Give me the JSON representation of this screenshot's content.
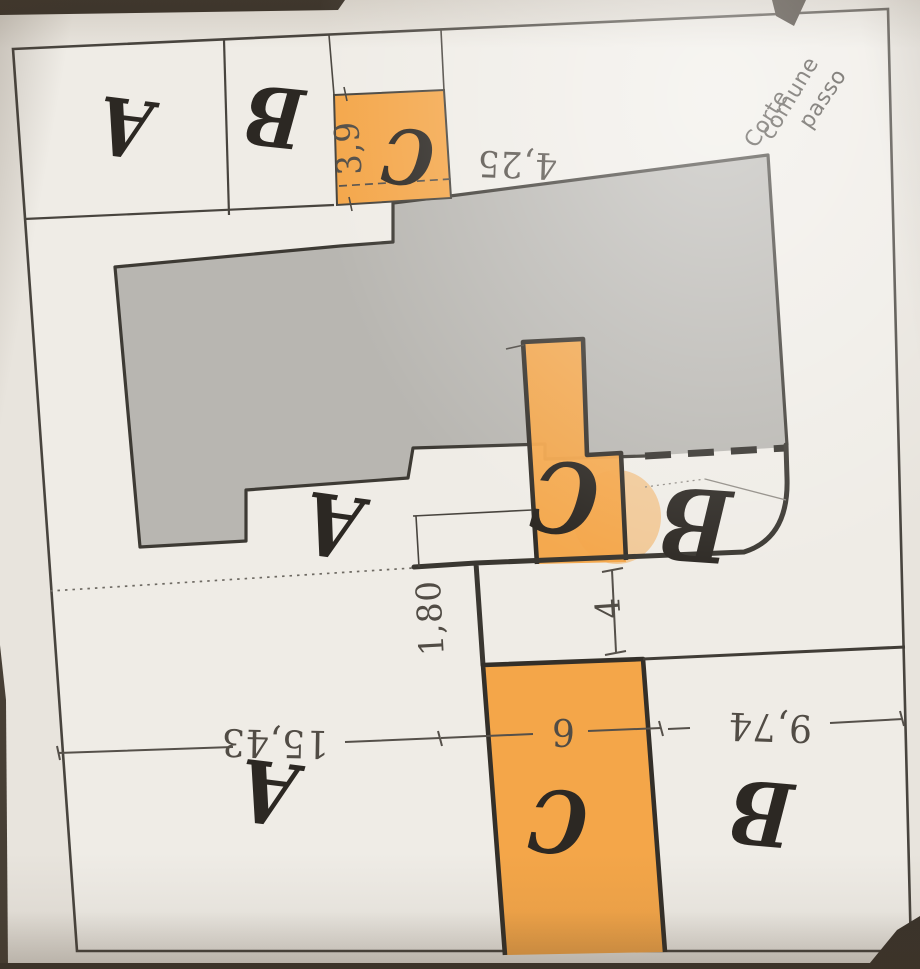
{
  "plan": {
    "corner_label": {
      "words": [
        {
          "name": "corner-word-corte",
          "text": "Corte",
          "x": 756,
          "y": 149,
          "rot": -58,
          "size": 22
        },
        {
          "name": "corner-word-comune",
          "text": "comune",
          "x": 772,
          "y": 141,
          "rot": -59,
          "size": 22
        },
        {
          "name": "corner-word-passo",
          "text": "passo",
          "x": 810,
          "y": 130,
          "rot": -56,
          "size": 22
        }
      ]
    },
    "parcel_letters": [
      {
        "name": "parcel-letter-a-top",
        "text": "A",
        "x": 125,
        "y": 127,
        "rot": 187,
        "size": 80
      },
      {
        "name": "parcel-letter-b-top",
        "text": "B",
        "x": 274,
        "y": 116,
        "rot": 186,
        "size": 82
      },
      {
        "name": "parcel-letter-c-top",
        "text": "C",
        "x": 408,
        "y": 156,
        "rot": 185,
        "size": 76
      },
      {
        "name": "parcel-letter-c-middle",
        "text": "C",
        "x": 565,
        "y": 496,
        "rot": 186,
        "size": 98
      },
      {
        "name": "parcel-letter-b-middle",
        "text": "B",
        "x": 695,
        "y": 524,
        "rot": 184,
        "size": 100
      },
      {
        "name": "parcel-letter-a-middle",
        "text": "A",
        "x": 333,
        "y": 525,
        "rot": 188,
        "size": 86
      },
      {
        "name": "parcel-letter-a-bottom",
        "text": "A",
        "x": 268,
        "y": 792,
        "rot": 187,
        "size": 86
      },
      {
        "name": "parcel-letter-c-bottom",
        "text": "C",
        "x": 558,
        "y": 821,
        "rot": 184,
        "size": 86
      },
      {
        "name": "parcel-letter-b-bottom",
        "text": "B",
        "x": 761,
        "y": 812,
        "rot": 185,
        "size": 88
      }
    ],
    "dimensions": [
      {
        "name": "dim-3-9",
        "text": "3,9",
        "x": 348,
        "y": 148,
        "rot": -94,
        "size": 34
      },
      {
        "name": "dim-4-25",
        "text": "4,25",
        "x": 517,
        "y": 164,
        "rot": 182,
        "size": 36
      },
      {
        "name": "dim-1-80",
        "text": "1,80",
        "x": 430,
        "y": 618,
        "rot": -93,
        "size": 34
      },
      {
        "name": "dim-4",
        "text": "4",
        "x": 608,
        "y": 608,
        "rot": -94,
        "size": 34
      },
      {
        "name": "dim-15-43",
        "text": "15,43",
        "x": 275,
        "y": 743,
        "rot": 181,
        "size": 38
      },
      {
        "name": "dim-6",
        "text": "6",
        "x": 563,
        "y": 732,
        "rot": 181,
        "size": 38
      },
      {
        "name": "dim-9-74",
        "text": "9,74",
        "x": 770,
        "y": 727,
        "rot": 182,
        "size": 38
      }
    ],
    "colors": {
      "highlight": "#f4a649",
      "building": "#b8b6b1",
      "paper": "#e8e4dd",
      "plot": "#efece6",
      "line": "#48443e",
      "ink": "#2c2823"
    }
  }
}
